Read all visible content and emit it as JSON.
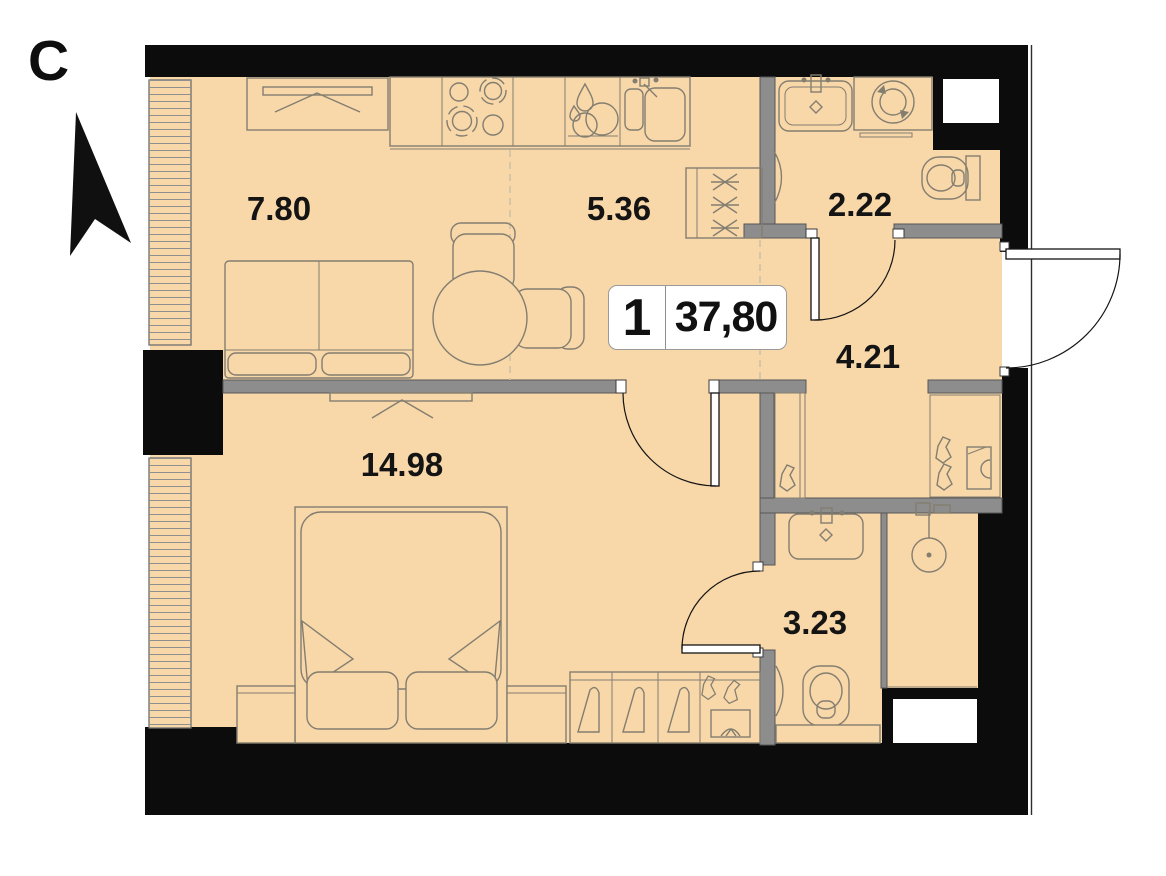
{
  "compass": {
    "label": "С"
  },
  "unit": {
    "number": "1",
    "total_area": "37,80"
  },
  "rooms": [
    {
      "name": "living-kitchen",
      "area": "7.80"
    },
    {
      "name": "kitchen-zone",
      "area": "5.36"
    },
    {
      "name": "bathroom-guest",
      "area": "2.22"
    },
    {
      "name": "hallway",
      "area": "4.21"
    },
    {
      "name": "bedroom",
      "area": "14.98"
    },
    {
      "name": "bathroom-master",
      "area": "3.23"
    }
  ],
  "fixtures": [
    "tv-console",
    "sofa",
    "dining-table",
    "chair",
    "cooktop",
    "dishwasher",
    "kitchen-sink",
    "coat-closet",
    "washing-machine",
    "bathroom-sink",
    "toilet",
    "towel-radiator",
    "wardrobe-niche",
    "shoe-rack",
    "shower",
    "double-bed",
    "nightstand",
    "pillow",
    "wardrobe-hangers",
    "entrance-door",
    "interior-door",
    "window",
    "ventilation-shaft"
  ],
  "colors": {
    "floor": "#f8d7a9",
    "wall-black": "#0c0c0c",
    "wall-gray": "#8d8d8d",
    "stroke": "#837e70",
    "dash": "#cfc2a6"
  }
}
